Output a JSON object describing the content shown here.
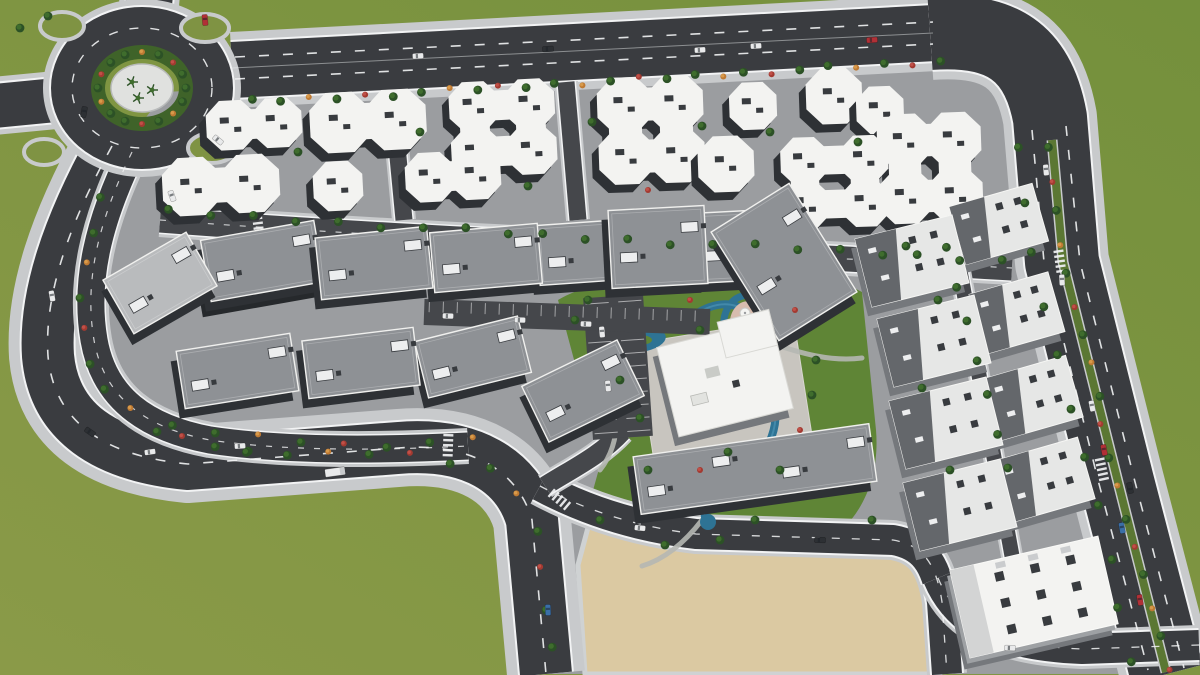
{
  "colors": {
    "grass_a": "#8a9a48",
    "grass_b": "#74903c",
    "grass_mid": "#7f9343",
    "pad": "#9b9da0",
    "asphalt": "#3a3c40",
    "asphalt_light": "#45474b",
    "sidewalk": "#c8cacc",
    "lane_white": "#f2f3f4",
    "median_green": "#5b7733",
    "lawn": "#5f8536",
    "sand": "#dbc9a2",
    "sand_edge": "#cfd2d3",
    "pool": "#2e7394",
    "pool_light": "#57a0bf",
    "plaza_pink": "#d8bcae",
    "roof_white": "#f3f3f1",
    "roof_gray": "#8e9195",
    "roof_gray_light": "#b9bbbd",
    "roof_dark_plane": "#64676b",
    "facade_dark": "#2e3135",
    "facade_mid": "#75787c",
    "roof_unit": "#edeeef",
    "roof_mark": "#383b3f",
    "island_ring": "#3f6329",
    "island_plaza": "#e0e1df",
    "path_gray": "#b5b7b3",
    "tree_dark": "#2c5126",
    "tree_mid": "#3f6d2d",
    "bush_orange": "#bf7a33",
    "bush_red": "#a33a31",
    "car_white": "#e9eaeb",
    "car_red": "#b13036",
    "car_blue": "#3a6fa8",
    "car_dark": "#2d3034"
  },
  "scene": {
    "type": "aerial-3d-render-residential-compound",
    "terrain": {
      "pad": "165,92 950,52 1022,96 1050,140 1076,300 1112,470 1152,640 1162,674 952,674 940,560 895,540 700,535 640,525 590,515 578,560 584,674 540,674 522,540 480,458 400,450 195,464 118,446 78,380 84,258 108,168",
      "lawn": "M 558,300 C 596,278 662,270 722,276 C 782,282 834,276 862,292 L 876,430 C 880,478 862,522 820,546 C 778,570 716,574 686,566 L 640,554 C 602,542 586,516 592,494 L 602,458 C 608,430 596,402 580,382 Z",
      "sand": "585,674 578,565 590,520 640,528 700,542 895,546 932,572 940,674"
    },
    "roads": [
      {
        "name": "top-highway",
        "d": "M 232,70 L 935,33",
        "w": [
          76,
          60,
          56
        ]
      },
      {
        "name": "east-boulevard",
        "d": "M 930,33 C 1002,28 1038,52 1050,118 L 1062,262 L 1117,482 L 1167,674",
        "w": [
          94,
          78,
          74
        ]
      },
      {
        "name": "west-outer-road",
        "d": "M 112,146 C 68,226 44,296 48,356 C 54,422 104,456 188,464 L 398,448 C 470,442 518,470 532,520 L 546,674",
        "w": [
          78,
          56,
          52
        ]
      },
      {
        "name": "inner-loop-road",
        "d": "M 132,152 C 98,222 84,282 94,340 C 104,398 146,428 210,440 C 290,452 390,450 468,446",
        "w": [
          36,
          30,
          27
        ]
      },
      {
        "name": "roundabout-north-arm",
        "d": "M 150,-6 L 146,36",
        "w": [
          60,
          50,
          46
        ]
      },
      {
        "name": "roundabout-west-arm",
        "d": "M -6,106 L 56,100",
        "w": [
          58,
          48,
          44
        ]
      },
      {
        "name": "top-internal-street",
        "d": "M 160,220 C 420,240 700,250 1012,268",
        "w": [
          34,
          28,
          25
        ],
        "l": 1
      },
      {
        "name": "sand-top-street",
        "d": "M 540,486 C 592,514 646,528 696,534 L 893,540 C 922,545 936,562 942,602 L 947,674",
        "w": [
          40,
          34,
          30
        ]
      },
      {
        "name": "southeast-connector",
        "d": "M 938,578 C 958,626 1004,646 1082,649 L 1199,645",
        "w": [
          40,
          34,
          30
        ]
      },
      {
        "name": "east-column-street",
        "d": "M 954,238 L 1012,556",
        "w": [
          22,
          18,
          15
        ],
        "l": 1
      },
      {
        "name": "cluster-alley-1",
        "d": "M 392,94 L 404,220",
        "w": [
          24,
          20,
          17
        ],
        "l": 1
      },
      {
        "name": "cluster-alley-2",
        "d": "M 566,82 L 578,220",
        "w": [
          24,
          20,
          17
        ],
        "l": 1
      },
      {
        "name": "club-access-lane",
        "d": "M 622,432 C 600,456 570,470 545,486",
        "w": [
          26,
          22,
          19
        ],
        "l": 1
      }
    ],
    "dashes": [
      {
        "d": "M 235,57 L 933,22",
        "w": 1.6,
        "dash": "10 14"
      },
      {
        "d": "M 235,79 L 933,44",
        "w": 1.6,
        "dash": "10 14"
      },
      {
        "d": "M 232,68 L 933,33",
        "w": 1,
        "dash": "",
        "op": 0.45
      },
      {
        "d": "M 1032,130 L 1044,262 L 1098,480 L 1148,670",
        "w": 1.6,
        "dash": "10 14"
      },
      {
        "d": "M 1066,126 L 1080,262 L 1134,478 L 1184,668",
        "w": 1.6,
        "dash": "10 14"
      },
      {
        "d": "M 112,146 C 68,226 44,296 48,356 C 54,422 104,456 188,464 L 398,448 C 470,442 518,470 532,520 L 546,674",
        "w": 1.6,
        "dash": "10 14"
      },
      {
        "d": "M 132,152 C 98,222 84,282 94,340 C 104,398 146,428 210,440 C 290,452 390,450 468,446",
        "w": 1.2,
        "dash": "6 10",
        "op": 0.8
      },
      {
        "d": "M 540,486 C 592,514 646,528 696,534 L 893,540 C 922,545 936,562 942,602 L 947,674",
        "w": 1.3,
        "dash": "8 12",
        "op": 0.85
      },
      {
        "d": "M 938,578 C 958,626 1004,646 1082,649 L 1199,645",
        "w": 1.3,
        "dash": "8 12",
        "op": 0.85
      },
      {
        "d": "M 160,220 C 420,240 700,250 1012,268",
        "w": 1.2,
        "dash": "6 10",
        "op": 0.75
      }
    ],
    "median": {
      "d": "M 1052,140 L 1063,262 L 1118,482 L 1166,672"
    },
    "roundabout": {
      "cx": 142,
      "cy": 88,
      "rx": 70,
      "ry": 60,
      "island_rx": 44,
      "island_ry": 36,
      "plaza_rx": 31,
      "plaza_ry": 24,
      "petals": [
        [
          205,
          28,
          24,
          14
        ],
        [
          62,
          26,
          22,
          14
        ],
        [
          44,
          152,
          20,
          13
        ],
        [
          212,
          148,
          24,
          15
        ]
      ]
    },
    "pool": {
      "stream": "M 612,342 C 600,330 610,318 632,322 C 654,326 668,334 684,322 C 700,310 718,300 736,306 C 757,313 769,323 767,341 C 765,357 769,373 773,391 C 777,411 777,426 769,443 C 759,463 741,477 723,491 C 707,503 701,513 707,521",
      "lagoon": {
        "cx": 640,
        "cy": 340,
        "rx": 26,
        "ry": 12,
        "rot": -8
      },
      "island": {
        "rx": 12,
        "ry": 5
      },
      "pondlet": {
        "cx": 603,
        "cy": 348,
        "rx": 9,
        "ry": 6
      },
      "endpond": {
        "cx": 708,
        "cy": 522,
        "r": 8
      },
      "plaza_ring": {
        "cx": 750,
        "cy": 326,
        "rx": 26,
        "ry": 31,
        "rot": -12
      },
      "plaza": {
        "cx": 750,
        "cy": 326,
        "rx": 20,
        "ry": 25,
        "rot": -12
      },
      "umbrellas": [
        [
          745,
          313
        ],
        [
          749,
          327
        ],
        [
          753,
          341
        ],
        [
          742,
          336
        ]
      ],
      "walkways": [
        "M 600,470 C 630,432 612,382 602,354",
        "M 770,300 C 792,282 814,272 840,268",
        "M 702,520 C 682,546 662,560 642,566",
        "M 768,342 C 802,354 832,362 862,358"
      ]
    },
    "buildings": [
      {
        "t": "cluster",
        "x": 162,
        "y": 158,
        "w": 118,
        "h": 54,
        "r": -3
      },
      {
        "t": "cluster",
        "x": 208,
        "y": 99,
        "w": 92,
        "h": 50,
        "r": -3
      },
      {
        "t": "cluster",
        "x": 312,
        "y": 92,
        "w": 112,
        "h": 58,
        "r": -3
      },
      {
        "t": "cluster",
        "x": 297,
        "y": 163,
        "w": 82,
        "h": 46,
        "r": -3
      },
      {
        "t": "cluster",
        "x": 407,
        "y": 152,
        "w": 92,
        "h": 48,
        "r": -3
      },
      {
        "t": "cluster",
        "x": 447,
        "y": 82,
        "w": 112,
        "h": 92,
        "r": -3
      },
      {
        "t": "cluster",
        "x": 600,
        "y": 78,
        "w": 102,
        "h": 104,
        "r": -2
      },
      {
        "t": "cluster",
        "x": 688,
        "y": 138,
        "w": 76,
        "h": 52,
        "r": -2
      },
      {
        "t": "cluster",
        "x": 712,
        "y": 84,
        "w": 82,
        "h": 44,
        "r": -2
      },
      {
        "t": "cluster",
        "x": 795,
        "y": 70,
        "w": 78,
        "h": 52,
        "r": -2
      },
      {
        "t": "cluster",
        "x": 775,
        "y": 138,
        "w": 120,
        "h": 88,
        "r": -2
      },
      {
        "t": "cluster",
        "x": 852,
        "y": 88,
        "w": 56,
        "h": 44,
        "r": -2
      },
      {
        "t": "cluster",
        "x": 880,
        "y": 112,
        "w": 100,
        "h": 112,
        "r": -2
      },
      {
        "t": "slab",
        "x": 112,
        "y": 252,
        "w": 96,
        "h": 62,
        "r": -30,
        "roof": "light"
      },
      {
        "t": "slab",
        "x": 205,
        "y": 230,
        "w": 115,
        "h": 62,
        "r": -10,
        "tall": 1
      },
      {
        "t": "slab",
        "x": 318,
        "y": 232,
        "w": 112,
        "h": 62,
        "r": -6
      },
      {
        "t": "slab",
        "x": 432,
        "y": 228,
        "w": 108,
        "h": 60,
        "r": -5
      },
      {
        "t": "slab",
        "x": 538,
        "y": 222,
        "w": 100,
        "h": 60,
        "r": -4
      },
      {
        "t": "slab",
        "x": 610,
        "y": 208,
        "w": 96,
        "h": 78,
        "r": -3
      },
      {
        "t": "slab",
        "x": 694,
        "y": 212,
        "w": 54,
        "h": 70,
        "r": -3
      },
      {
        "t": "slab",
        "x": 738,
        "y": 198,
        "w": 92,
        "h": 128,
        "r": -32
      },
      {
        "t": "slab",
        "x": 180,
        "y": 342,
        "w": 115,
        "h": 58,
        "r": -9
      },
      {
        "t": "slab",
        "x": 305,
        "y": 334,
        "w": 112,
        "h": 58,
        "r": -7
      },
      {
        "t": "slab",
        "x": 420,
        "y": 328,
        "w": 106,
        "h": 58,
        "r": -14
      },
      {
        "t": "slab",
        "x": 530,
        "y": 360,
        "w": 106,
        "h": 62,
        "r": -26
      },
      {
        "t": "slab",
        "x": 636,
        "y": 440,
        "w": 238,
        "h": 58,
        "r": -8,
        "units": 4
      },
      {
        "t": "white",
        "x": 862,
        "y": 226,
        "w": 100,
        "h": 70,
        "r": -14
      },
      {
        "t": "white",
        "x": 956,
        "y": 194,
        "w": 86,
        "h": 60,
        "r": -16
      },
      {
        "t": "white",
        "x": 884,
        "y": 306,
        "w": 100,
        "h": 70,
        "r": -14
      },
      {
        "t": "white",
        "x": 976,
        "y": 282,
        "w": 82,
        "h": 62,
        "r": -16
      },
      {
        "t": "white",
        "x": 896,
        "y": 388,
        "w": 100,
        "h": 70,
        "r": -14
      },
      {
        "t": "white",
        "x": 990,
        "y": 366,
        "w": 86,
        "h": 64,
        "r": -16
      },
      {
        "t": "white",
        "x": 910,
        "y": 470,
        "w": 100,
        "h": 70,
        "r": -14
      },
      {
        "t": "white",
        "x": 1000,
        "y": 448,
        "w": 88,
        "h": 64,
        "r": -16
      },
      {
        "t": "big",
        "x": 958,
        "y": 552,
        "w": 152,
        "h": 90,
        "r": -13
      },
      {
        "t": "club",
        "x": 666,
        "y": 332,
        "w": 118,
        "h": 92,
        "r": -14
      }
    ],
    "club_plot": {
      "x": 644,
      "y": 330,
      "w": 160,
      "h": 122,
      "r": -9
    },
    "parking": [
      {
        "x": 588,
        "y": 296,
        "w": 60,
        "h": 142,
        "r": -4,
        "rows": 2
      },
      {
        "x": 424,
        "y": 304,
        "w": 286,
        "h": 26,
        "r": 2,
        "rows": 1
      }
    ],
    "tree_rows": [
      {
        "pts": [
          [
            256,
            102
          ],
          [
            560,
            84
          ],
          [
            938,
            62
          ]
        ],
        "n": 26,
        "k": "mix"
      },
      {
        "pts": [
          [
            1052,
            150
          ],
          [
            1063,
            262
          ],
          [
            1118,
            482
          ],
          [
            1166,
            668
          ]
        ],
        "n": 18,
        "k": "med"
      },
      {
        "pts": [
          [
            1022,
            150
          ],
          [
            1034,
            262
          ],
          [
            1088,
            478
          ],
          [
            1134,
            660
          ]
        ],
        "n": 11,
        "k": "g"
      },
      {
        "pts": [
          [
            104,
            200
          ],
          [
            80,
            300
          ],
          [
            92,
            380
          ],
          [
            150,
            430
          ],
          [
            250,
            452
          ]
        ],
        "n": 12,
        "k": "mix"
      },
      {
        "pts": [
          [
            250,
            455
          ],
          [
            400,
            452
          ],
          [
            498,
            470
          ],
          [
            540,
            540
          ],
          [
            554,
            648
          ]
        ],
        "n": 12,
        "k": "mix"
      },
      {
        "pts": [
          [
            172,
            212
          ],
          [
            520,
            234
          ],
          [
            1004,
            260
          ]
        ],
        "n": 21,
        "k": "g"
      },
      {
        "pts": [
          [
            176,
            428
          ],
          [
            360,
            446
          ],
          [
            470,
            440
          ]
        ],
        "n": 8,
        "k": "mix"
      },
      {
        "pts": [
          [
            950,
            250
          ],
          [
            1006,
            468
          ]
        ],
        "n": 7,
        "k": "g"
      },
      {
        "ring": [
          142,
          88,
          44,
          36
        ],
        "n": 16,
        "k": "mix"
      }
    ],
    "tree_scatter": [
      [
        298,
        152,
        "g"
      ],
      [
        420,
        132,
        "g"
      ],
      [
        592,
        122,
        "g"
      ],
      [
        702,
        126,
        "g"
      ],
      [
        858,
        142,
        "g"
      ],
      [
        528,
        186,
        "g"
      ],
      [
        648,
        190,
        "r"
      ],
      [
        770,
        132,
        "g"
      ],
      [
        906,
        246,
        "g"
      ],
      [
        922,
        388,
        "g"
      ],
      [
        938,
        300,
        "g"
      ],
      [
        950,
        470,
        "g"
      ],
      [
        872,
        520,
        "g"
      ],
      [
        20,
        28,
        "g"
      ],
      [
        48,
        16,
        "g"
      ],
      [
        575,
        320,
        "g"
      ],
      [
        588,
        300,
        "g"
      ],
      [
        620,
        380,
        "g"
      ],
      [
        648,
        470,
        "g"
      ],
      [
        600,
        520,
        "g"
      ],
      [
        665,
        545,
        "g"
      ],
      [
        700,
        470,
        "r"
      ],
      [
        728,
        452,
        "g"
      ],
      [
        780,
        470,
        "g"
      ],
      [
        800,
        430,
        "r"
      ],
      [
        812,
        395,
        "g"
      ],
      [
        816,
        360,
        "g"
      ],
      [
        795,
        310,
        "r"
      ],
      [
        700,
        330,
        "g"
      ],
      [
        690,
        300,
        "r"
      ],
      [
        640,
        418,
        "g"
      ],
      [
        720,
        540,
        "g"
      ],
      [
        755,
        520,
        "g"
      ]
    ],
    "palms": [
      [
        132,
        82
      ],
      [
        152,
        90
      ],
      [
        138,
        98
      ]
    ],
    "vehicles": [
      {
        "x": 418,
        "y": 56,
        "a": -3,
        "c": "white"
      },
      {
        "x": 548,
        "y": 49,
        "a": -3,
        "c": "dark"
      },
      {
        "x": 700,
        "y": 50,
        "a": -3,
        "c": "white"
      },
      {
        "x": 756,
        "y": 46,
        "a": -3,
        "c": "white"
      },
      {
        "x": 872,
        "y": 40,
        "a": -3,
        "c": "red"
      },
      {
        "x": 205,
        "y": 20,
        "a": 85,
        "c": "red"
      },
      {
        "x": 84,
        "y": 112,
        "a": 100,
        "c": "dark"
      },
      {
        "x": 218,
        "y": 140,
        "a": 40,
        "c": "white"
      },
      {
        "x": 172,
        "y": 196,
        "a": 70,
        "c": "white"
      },
      {
        "x": 52,
        "y": 296,
        "a": 80,
        "c": "white"
      },
      {
        "x": 90,
        "y": 432,
        "a": 35,
        "c": "dark"
      },
      {
        "x": 150,
        "y": 452,
        "a": -8,
        "c": "white"
      },
      {
        "x": 335,
        "y": 472,
        "a": -8,
        "c": "truck"
      },
      {
        "x": 240,
        "y": 446,
        "a": -4,
        "c": "white"
      },
      {
        "x": 548,
        "y": 610,
        "a": 88,
        "c": "blue"
      },
      {
        "x": 640,
        "y": 528,
        "a": 5,
        "c": "white"
      },
      {
        "x": 820,
        "y": 540,
        "a": 2,
        "c": "dark"
      },
      {
        "x": 1046,
        "y": 170,
        "a": 85,
        "c": "white"
      },
      {
        "x": 1062,
        "y": 280,
        "a": 87,
        "c": "white"
      },
      {
        "x": 1092,
        "y": 406,
        "a": 79,
        "c": "white"
      },
      {
        "x": 1104,
        "y": 450,
        "a": 79,
        "c": "red"
      },
      {
        "x": 1122,
        "y": 528,
        "a": 80,
        "c": "blue"
      },
      {
        "x": 1140,
        "y": 600,
        "a": 80,
        "c": "red"
      },
      {
        "x": 1130,
        "y": 488,
        "a": -100,
        "c": "dark"
      },
      {
        "x": 1010,
        "y": 648,
        "a": 2,
        "c": "white"
      },
      {
        "x": 602,
        "y": 332,
        "a": 85,
        "c": "white"
      },
      {
        "x": 608,
        "y": 386,
        "a": 85,
        "c": "white"
      },
      {
        "x": 448,
        "y": 316,
        "a": 2,
        "c": "white"
      },
      {
        "x": 520,
        "y": 320,
        "a": 2,
        "c": "white"
      },
      {
        "x": 586,
        "y": 324,
        "a": 2,
        "c": "white"
      }
    ],
    "crosswalks": [
      [
        258,
        224,
        83
      ],
      [
        448,
        446,
        92
      ],
      [
        560,
        500,
        40
      ],
      [
        1060,
        262,
        82
      ],
      [
        1102,
        470,
        78
      ]
    ],
    "counts": {
      "white_cluster_roofs": 13,
      "gray_slab_blocks": 13,
      "white_blocks": 8,
      "corner_block": 1,
      "clubhouse": 1,
      "umbrellas": 4
    }
  }
}
